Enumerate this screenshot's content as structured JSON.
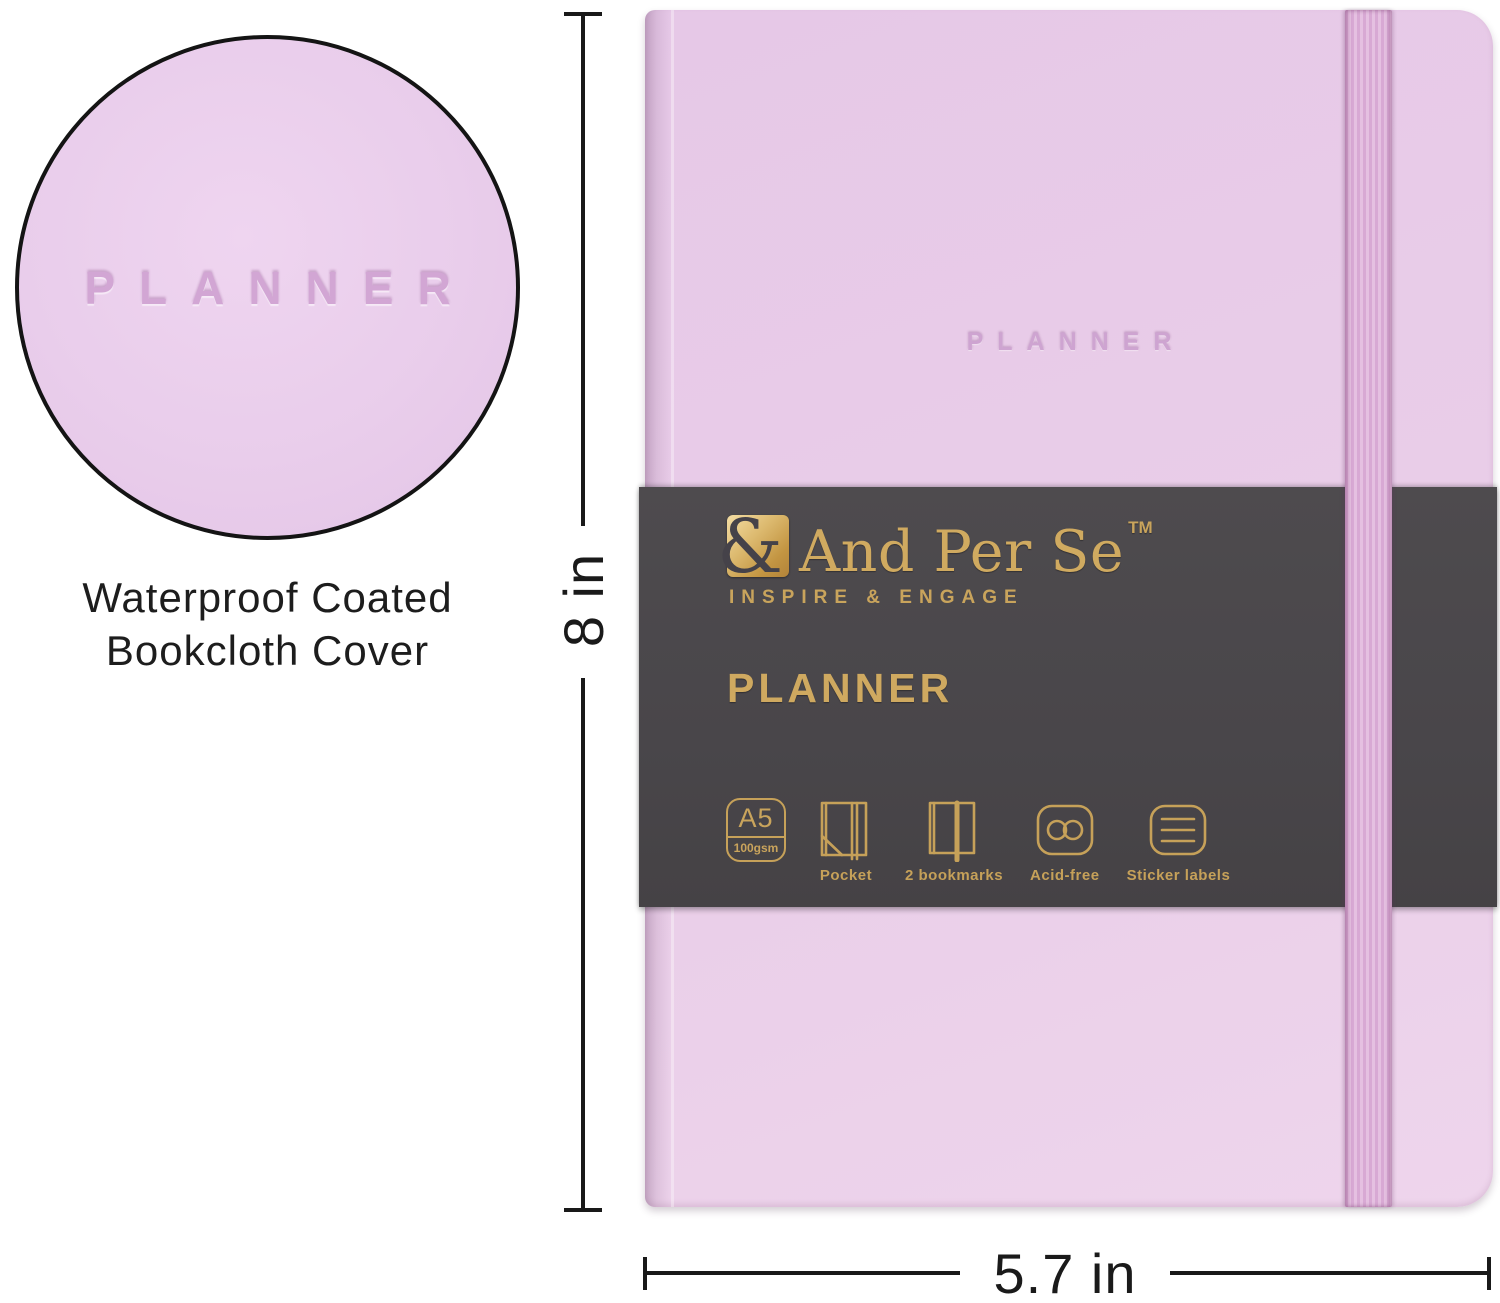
{
  "inset": {
    "embossed_text": "PLANNER",
    "caption_line1": "Waterproof Coated",
    "caption_line2": "Bookcloth Cover"
  },
  "notebook": {
    "cover_embossed_text": "PLANNER"
  },
  "band": {
    "logo_ampersand": "&",
    "logo_text": "And Per Se",
    "trademark": "TM",
    "tagline": "INSPIRE & ENGAGE",
    "title": "PLANNER",
    "paper_size": "A5",
    "paper_weight": "100gsm",
    "features": [
      {
        "label": "Pocket"
      },
      {
        "label": "2 bookmarks"
      },
      {
        "label": "Acid-free"
      },
      {
        "label": "Sticker labels"
      }
    ]
  },
  "dimensions": {
    "height": "8 in",
    "width": "5.7 in"
  },
  "colors": {
    "cover": "#e8cce9",
    "elastic": "#dcb2d8",
    "band_background": "#4a474a",
    "gold_foil": "#c9a45c"
  }
}
